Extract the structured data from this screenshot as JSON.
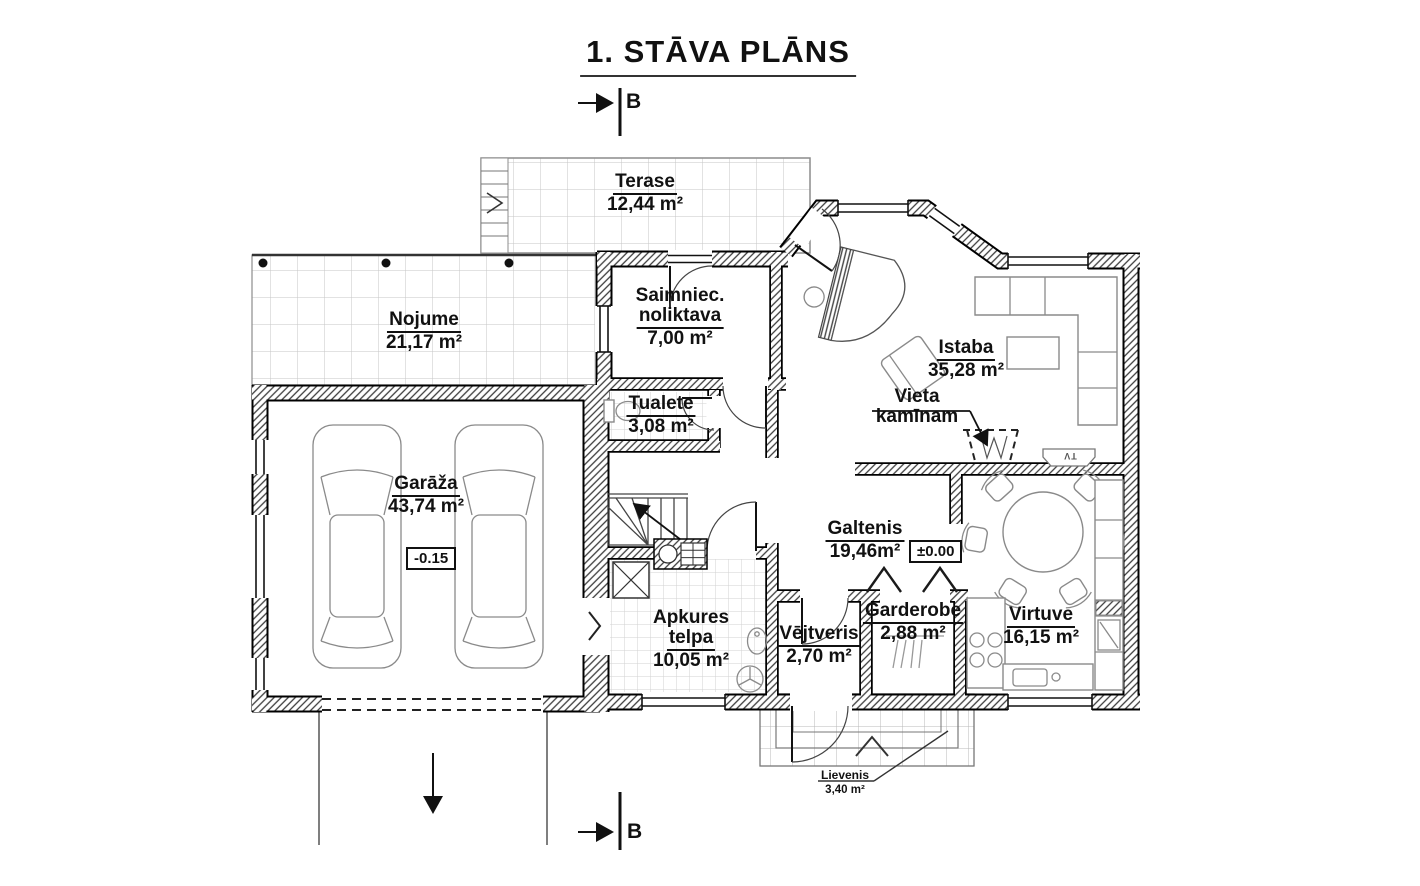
{
  "title": "1. STĀVA PLĀNS",
  "section_marker": "B",
  "rooms": {
    "terase": {
      "name": "Terase",
      "area": "12,44 m²"
    },
    "nojume": {
      "name": "Nojume",
      "area": "21,17 m²"
    },
    "saimnieciba": {
      "line1": "Saimniec.",
      "line2": "noliktava",
      "area": "7,00 m²"
    },
    "tualete": {
      "name": "Tualete",
      "area": "3,08 m²"
    },
    "istaba": {
      "name": "Istaba",
      "area": "35,28 m²"
    },
    "vieta_kaminam": {
      "line1": "Vieta",
      "line2": "kamīnam"
    },
    "garaza": {
      "name": "Garāža",
      "area": "43,74 m²",
      "level": "-0.15"
    },
    "galtenis": {
      "name": "Galtenis",
      "area": "19,46m²",
      "level": "±0.00"
    },
    "apkures": {
      "line1": "Apkures",
      "line2": "telpa",
      "area": "10,05 m²"
    },
    "vejtveris": {
      "name": "Vējtveris",
      "area": "2,70 m²"
    },
    "garderobe": {
      "name": "Garderobe",
      "area": "2,88 m²"
    },
    "virtuve": {
      "name": "Virtuve",
      "area": "16,15 m²"
    },
    "lievenis": {
      "name": "Lievenis",
      "area": "3,40 m²"
    }
  },
  "annotations": {
    "tv": "TV"
  },
  "colors": {
    "line": "#000000",
    "furniture": "#8a8a8a",
    "tile": "#c6c6c6",
    "background": "#ffffff"
  }
}
